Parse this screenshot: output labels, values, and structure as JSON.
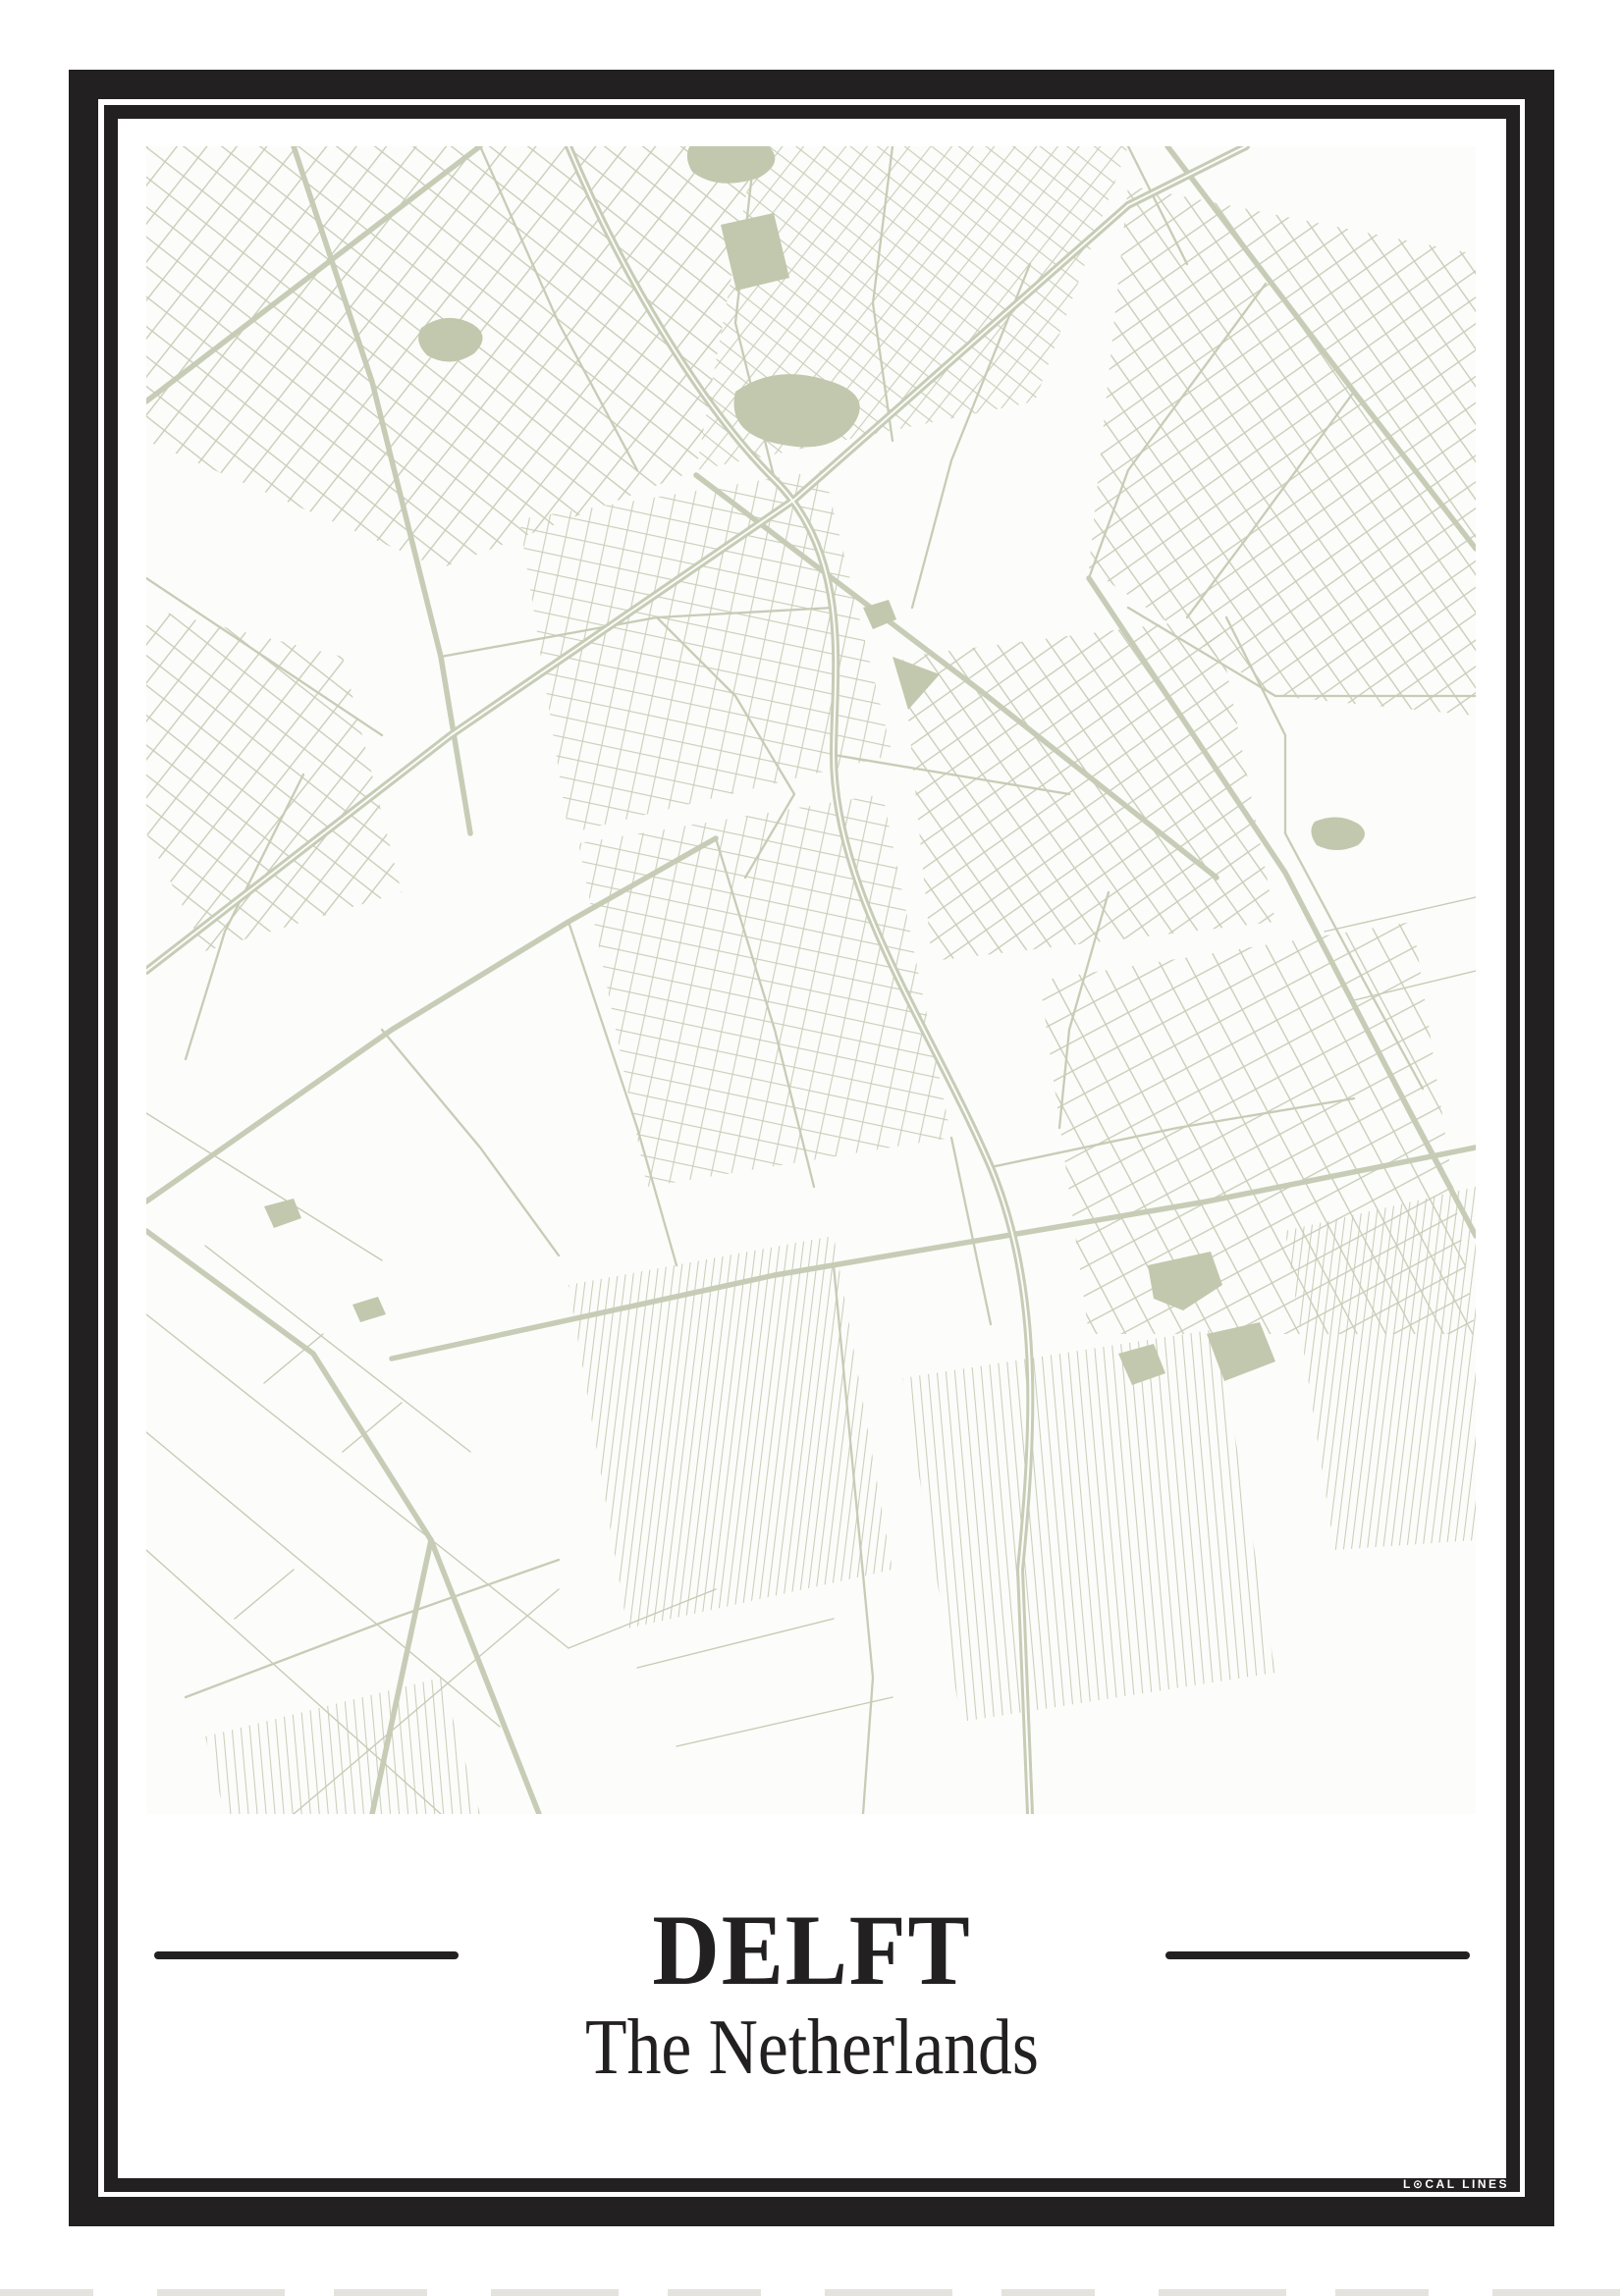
{
  "poster": {
    "title": "DELFT",
    "subtitle": "The Netherlands",
    "brand": "LOCAL LINES",
    "brand_display": "L⊙CAL LINES"
  },
  "map": {
    "type": "minimal-street-map",
    "city": "Delft",
    "country": "The Netherlands"
  },
  "colors": {
    "ink": "#232021",
    "paper": "#ffffff",
    "map_paper": "#fcfcfa",
    "map_line": "#c7ccb6",
    "map_fill": "#c2c8ad",
    "brand_text": "#ffffff",
    "sliver": "#dcdad3"
  }
}
